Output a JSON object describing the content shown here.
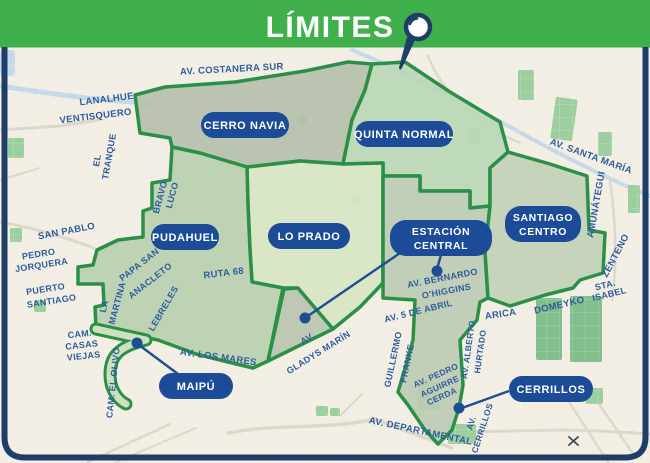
{
  "header": {
    "title": "LÍMITES"
  },
  "colors": {
    "header_bg": "#3fb04b",
    "frame": "#1d3e66",
    "map_bg": "#f3eee3",
    "boundary": "#2b9047",
    "street_label": "#2d5d9e",
    "badge_bg": "#1c4b97",
    "badge_text": "#ffffff",
    "callout": "#1d4e8f",
    "river": "#c5d8e9",
    "road": "#dcd7cb",
    "park": "#9ccf9d",
    "park_dark": "#82bf8d",
    "region_cerro_navia": "#b5bfab",
    "region_quinta_normal": "#b9d7b5",
    "region_pudahuel": "#b8cfae",
    "region_lo_prado": "#d6e6c2",
    "region_estacion_central": "#bccbb3",
    "region_estacion_central_exclave": "#b8c3ae",
    "region_santiago_centro": "#c2d0b7",
    "region_maipu": "#cde1c0",
    "x_marker": "#3a4a5a"
  },
  "districts": [
    {
      "id": "cerro-navia",
      "label": "CERRO NAVIA"
    },
    {
      "id": "quinta-normal",
      "label": "QUINTA NORMAL"
    },
    {
      "id": "pudahuel",
      "label": "PUDAHUEL"
    },
    {
      "id": "lo-prado",
      "label": "LO PRADO"
    },
    {
      "id": "estacion-central",
      "label": "ESTACIÓN",
      "label2": "CENTRAL"
    },
    {
      "id": "santiago-centro",
      "label": "SANTIAGO",
      "label2": "CENTRO"
    },
    {
      "id": "maipu",
      "label": "MAIPÚ"
    },
    {
      "id": "cerrillos",
      "label": "CERRILLOS"
    }
  ],
  "streets": [
    "AV. COSTANERA SUR",
    "LANALHUE",
    "VENTISQUERO",
    "EL",
    "TRANQUE",
    "BRAVO",
    "LUCO",
    "SAN PABLO",
    "PEDRO",
    "JORQUERA",
    "PUERTO",
    "SANTIAGO",
    "CAM.",
    "CASAS",
    "VIEJAS",
    "LA",
    "MARTINA",
    "PAPA SAN",
    "ANACLETO",
    "LEBRELES",
    "CAM. EL OLIVO",
    "RUTA 68",
    "AV. LOS MARES",
    "AV.",
    "GLADYS MARÍN",
    "AV. BERNARDO",
    "O'HIGGINS",
    "AV. 5 DE ABRIL",
    "GUILLERMO",
    "FRANKE",
    "AV. PEDRO",
    "AGUIRRE",
    "CERDA",
    "AV. ALBERTO",
    "HURTADO",
    "ARICA",
    "DOMEYKO",
    "STA.",
    "ISABEL",
    "AMUNÁTEGUI",
    "ZENTENO",
    "AV. SANTA MARÍA",
    "AV. DEPARTAMENTAL",
    "AV.",
    "CERRILLOS"
  ]
}
